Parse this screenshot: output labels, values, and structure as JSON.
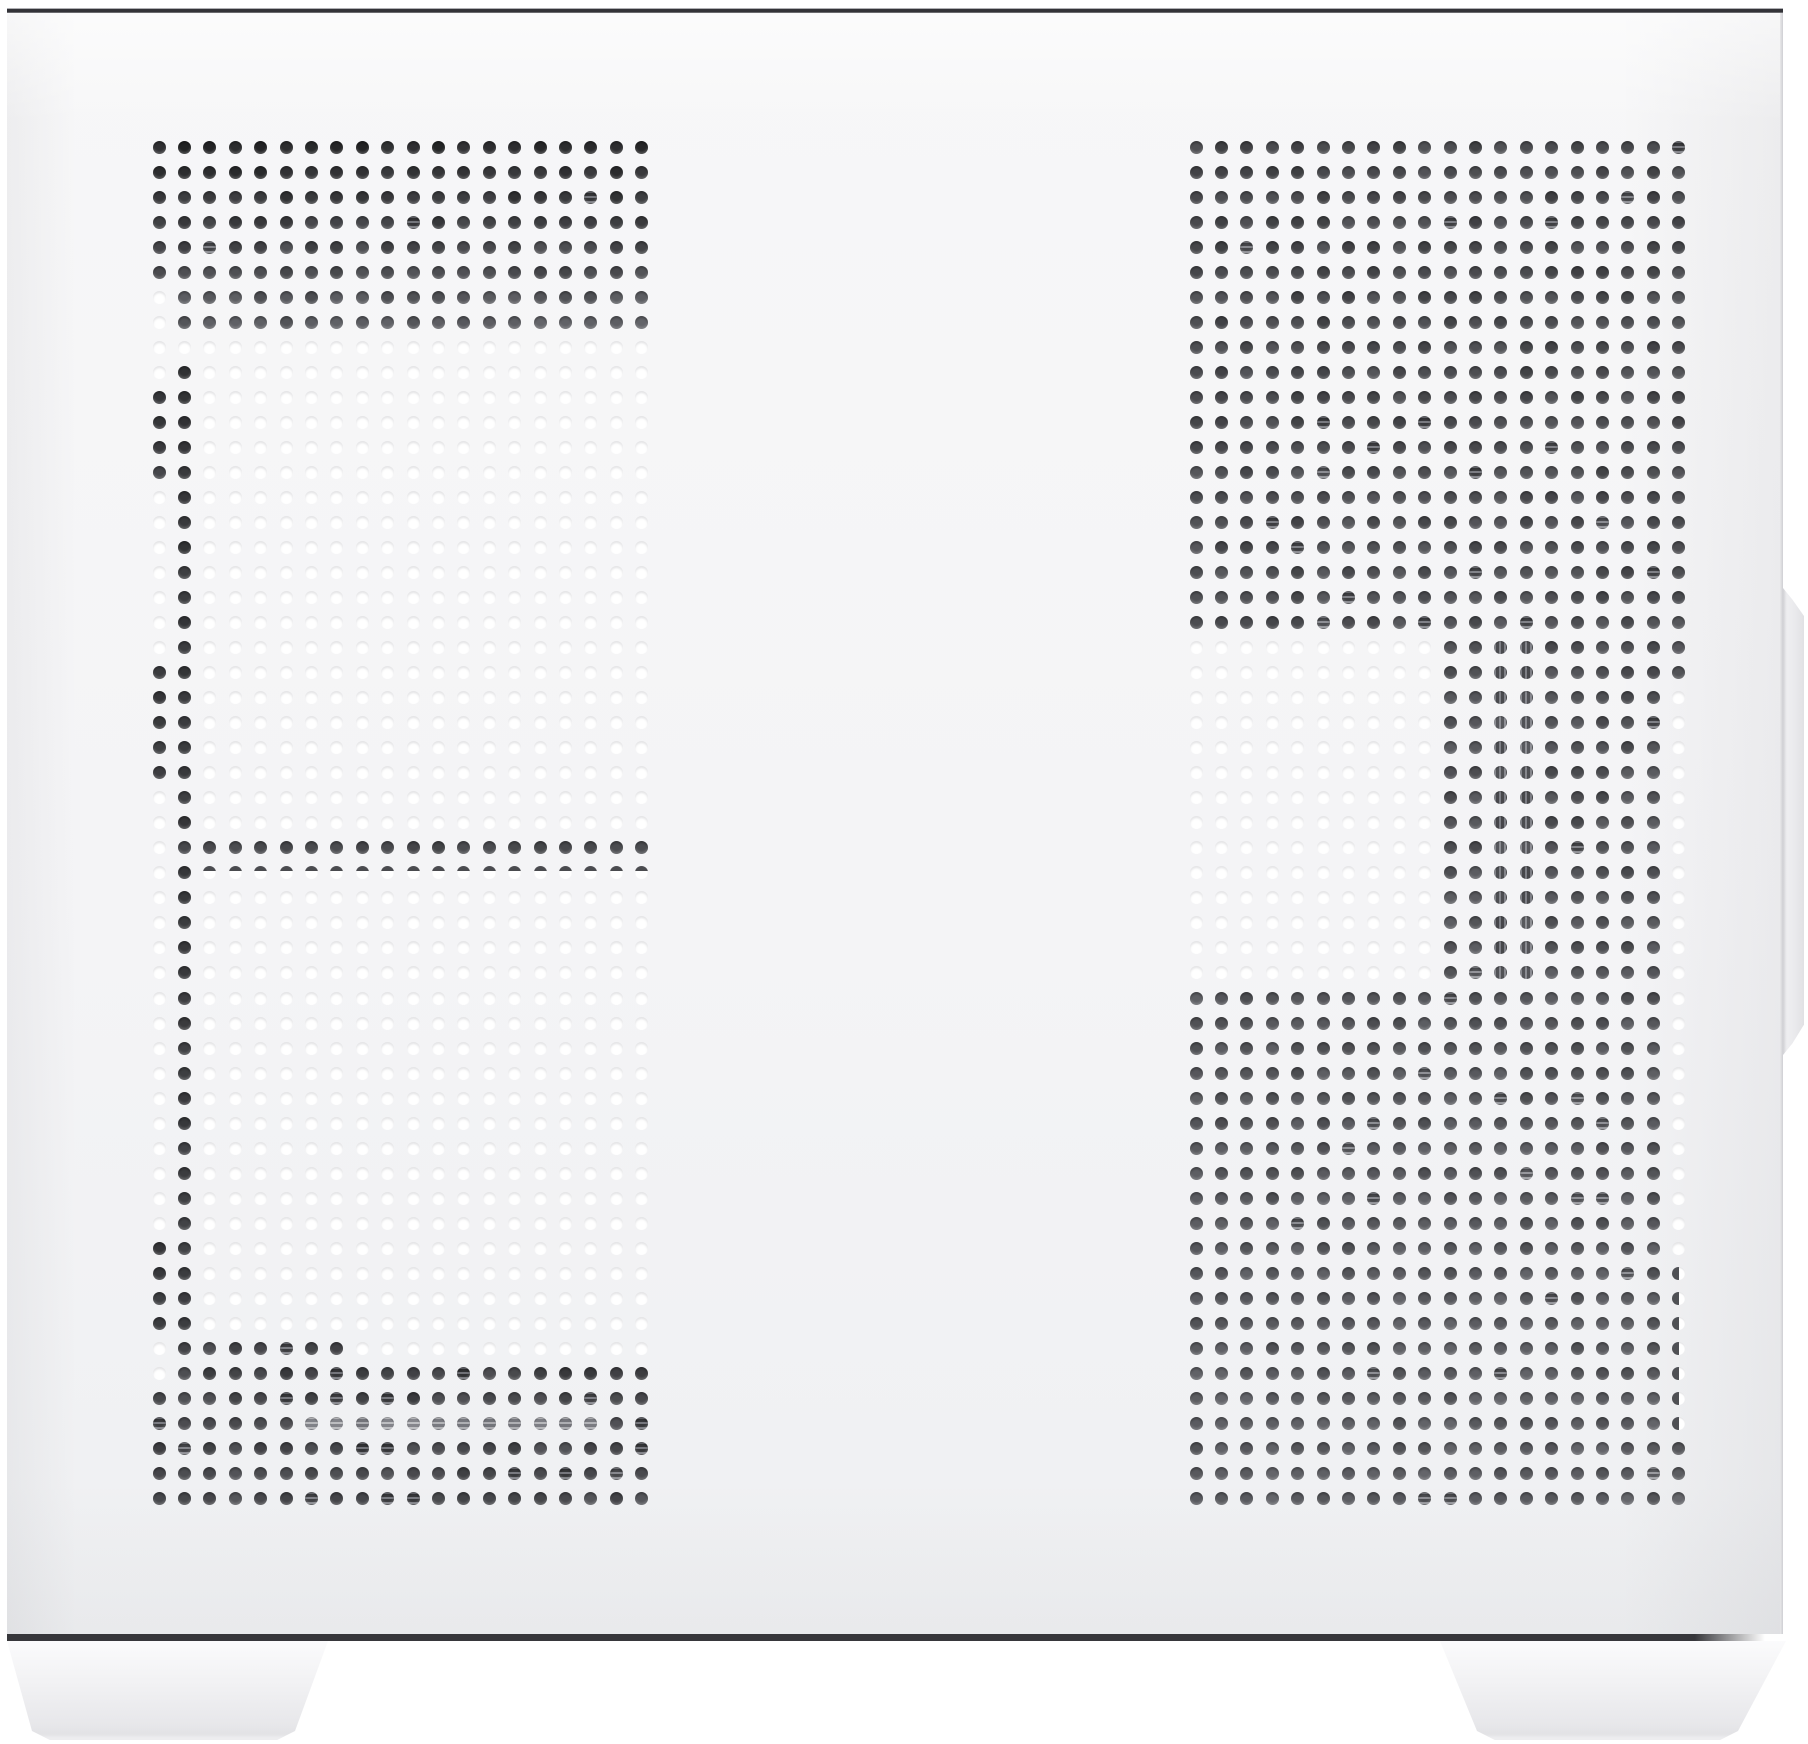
{
  "image": {
    "type": "product-photo",
    "subject": "white-pc-case-side-panel-with-dual-perforated-vent-grids",
    "canvas": {
      "width": 1808,
      "height": 1744
    }
  },
  "colors": {
    "background": "#ffffff",
    "panel_top": "#f7f7f8",
    "panel_mid": "#f4f4f6",
    "panel_bottom": "#eff0f2",
    "top_edge_core": "#333338",
    "top_edge_light": "#b0b0b4",
    "top_edge_sheen": "#fafafb",
    "bottom_edge_core": "#37373b",
    "right_edge_light": "#e8e8ea",
    "right_edge_dark": "#cfcfd3",
    "tab_left": "#f1f1f3",
    "tab_mid": "#e9e9ec",
    "tab_right": "#e1e1e4",
    "foot_top": "#fbfbfc",
    "foot_mid": "#f1f1f3",
    "foot_low": "#e7e7ea",
    "foot_bottom": "#dfdfe2",
    "hole_white": "#ffffff",
    "hole_gray_hue": 230,
    "hole_gray_sat": 3
  },
  "geometry": {
    "case_panel": {
      "x": 7,
      "y": 13,
      "width": 1776,
      "height": 1621
    },
    "top_line": {
      "x": 7,
      "y": 8,
      "width": 1776,
      "height": 6
    },
    "bottom_line": {
      "x": 7,
      "y": 1634,
      "width": 1758,
      "height": 7
    },
    "right_edge": {
      "x": 1780,
      "y": 13,
      "width": 3,
      "height": 1621
    },
    "tab": {
      "x": 1783,
      "y": 588,
      "width": 21,
      "height": 467
    },
    "left_foot": {
      "x": 7,
      "y": 1641,
      "width": 321,
      "height": 99,
      "bottom_left_inset": 29,
      "bottom_right_inset": 37
    },
    "right_foot": {
      "x": 1440,
      "y": 1641,
      "width": 346,
      "height": 99,
      "bottom_left_inset": 41,
      "bottom_right_inset": 52
    }
  },
  "grids": {
    "hole_diameter": 13,
    "left": {
      "x0": 159,
      "y0": 147,
      "cols": 20,
      "rows": 55,
      "pitch_x": 25.4,
      "pitch_y": 25.03,
      "rules": [
        {
          "rows": [
            0,
            54
          ],
          "cols": [
            0,
            19
          ],
          "shade": "white"
        },
        {
          "rows": [
            0,
            7
          ],
          "cols": [
            0,
            19
          ],
          "shade": "dark_top_block"
        },
        {
          "rows": [
            6,
            8
          ],
          "cols": [
            0,
            0
          ],
          "shade": "white"
        },
        {
          "rows": [
            8,
            8
          ],
          "cols": [
            7,
            19
          ],
          "shade": "white"
        },
        {
          "rows": [
            9,
            54
          ],
          "cols": [
            1,
            1
          ],
          "shade": "dark_column"
        },
        {
          "rows": [
            10,
            13
          ],
          "cols": [
            0,
            0
          ],
          "shade": "dark_column"
        },
        {
          "rows": [
            21,
            25
          ],
          "cols": [
            0,
            0
          ],
          "shade": "dark_column"
        },
        {
          "rows": [
            28,
            28
          ],
          "cols": [
            1,
            19
          ],
          "shade": "dark_row_band"
        },
        {
          "rows": [
            29,
            29
          ],
          "cols": [
            2,
            19
          ],
          "shade": "half_top"
        },
        {
          "rows": [
            44,
            47
          ],
          "cols": [
            0,
            0
          ],
          "shade": "dark_column"
        },
        {
          "rows": [
            48,
            48
          ],
          "cols": [
            2,
            7
          ],
          "shade": "dark_patch"
        },
        {
          "rows": [
            49,
            54
          ],
          "cols": [
            0,
            19
          ],
          "shade": "dark_bottom_block"
        },
        {
          "rows": [
            49,
            49
          ],
          "cols": [
            0,
            0
          ],
          "shade": "white"
        },
        {
          "rows": [
            51,
            51
          ],
          "cols": [
            6,
            17
          ],
          "shade": "stripe_light"
        }
      ]
    },
    "right": {
      "x0": 1196,
      "y0": 147,
      "cols": 20,
      "rows": 55,
      "pitch_x": 25.4,
      "pitch_y": 25.03,
      "rules": [
        {
          "rows": [
            0,
            54
          ],
          "cols": [
            0,
            19
          ],
          "shade": "dark_right_block"
        },
        {
          "rows": [
            20,
            33
          ],
          "cols": [
            12,
            13
          ],
          "shade": "stripe_dark"
        },
        {
          "rows": [
            20,
            33
          ],
          "cols": [
            0,
            9
          ],
          "shade": "white"
        },
        {
          "rows": [
            22,
            44
          ],
          "cols": [
            19,
            19
          ],
          "shade": "white"
        },
        {
          "rows": [
            45,
            51
          ],
          "cols": [
            19,
            19
          ],
          "shade": "half_right"
        }
      ]
    },
    "shades": {
      "white": {
        "type": "white"
      },
      "half_top": {
        "type": "half_top",
        "l": 30
      },
      "half_right": {
        "type": "half_right",
        "l": 32
      },
      "dark_top_block": {
        "type": "dark",
        "l0": 17,
        "l1": 37,
        "jitter": 7,
        "stripe_chance": 0.04
      },
      "dark_column": {
        "type": "dark",
        "l0": 22,
        "l1": 26,
        "jitter": 5,
        "stripe_chance": 0
      },
      "dark_row_band": {
        "type": "dark",
        "l0": 29,
        "l1": 31,
        "jitter": 4,
        "stripe_chance": 0
      },
      "dark_patch": {
        "type": "dark",
        "l0": 30,
        "l1": 34,
        "jitter": 9,
        "stripe_chance": 0.15
      },
      "dark_bottom_block": {
        "type": "dark",
        "l0": 27,
        "l1": 30,
        "jitter": 9,
        "stripe_chance": 0.15
      },
      "dark_right_block": {
        "type": "dark",
        "l0": 29,
        "l1": 37,
        "jitter": 8,
        "stripe_chance": 0.05
      },
      "stripe_light": {
        "type": "stripe",
        "l": 58,
        "jitter": 8,
        "dir": 180
      },
      "stripe_dark": {
        "type": "stripe",
        "l": 40,
        "jitter": 8,
        "dir": 90
      }
    }
  }
}
